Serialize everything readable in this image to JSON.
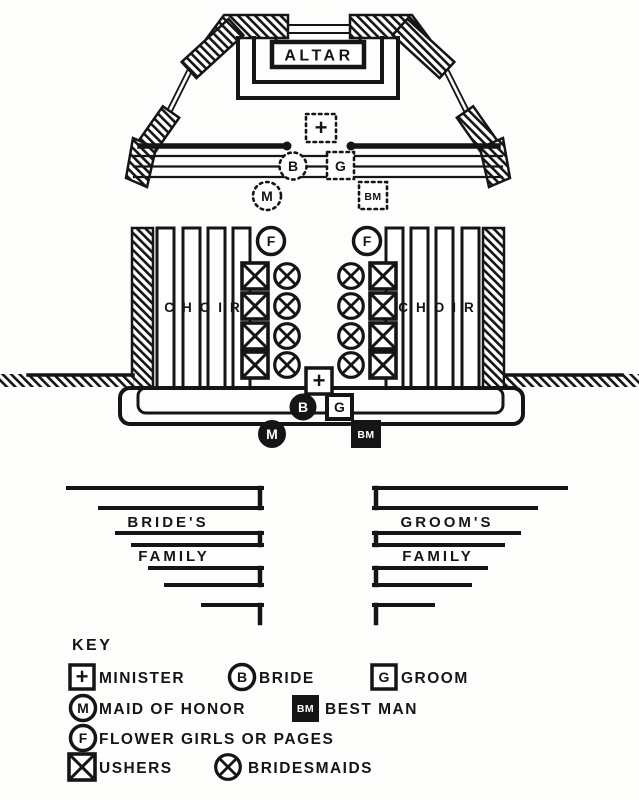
{
  "colors": {
    "ink": "#151515",
    "paper": "#fdfdfc"
  },
  "diagram": {
    "altar_label": "ALTAR",
    "choir_label": "CHOIR",
    "symbols": {
      "minister": "+",
      "bride": "B",
      "groom": "G",
      "maid_of_honor": "M",
      "best_man": "BM",
      "flower": "F",
      "usher": "X",
      "bridesmaid": "X"
    },
    "pews": {
      "brides_family": [
        "BRIDE'S",
        "FAMILY"
      ],
      "grooms_family": [
        "GROOM'S",
        "FAMILY"
      ]
    }
  },
  "key": {
    "title": "KEY",
    "entries": [
      {
        "shape": "square",
        "symbol": "+",
        "label": "MINISTER"
      },
      {
        "shape": "circle",
        "symbol": "B",
        "label": "BRIDE"
      },
      {
        "shape": "square",
        "symbol": "G",
        "label": "GROOM"
      },
      {
        "shape": "circle",
        "symbol": "M",
        "label": "MAID OF HONOR"
      },
      {
        "shape": "square",
        "symbol": "BM",
        "label": "BEST MAN"
      },
      {
        "shape": "circle",
        "symbol": "F",
        "label": "FLOWER GIRLS OR PAGES"
      },
      {
        "shape": "square",
        "symbol": "X",
        "label": "USHERS"
      },
      {
        "shape": "circle",
        "symbol": "X",
        "label": "BRIDESMAIDS"
      }
    ]
  }
}
